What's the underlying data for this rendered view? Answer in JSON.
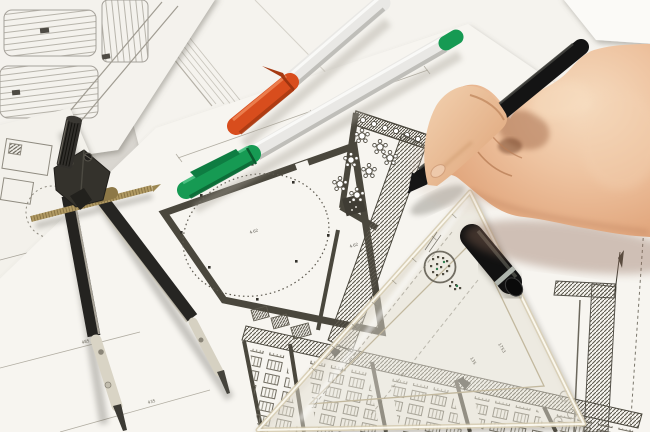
{
  "scene": {
    "description": "Overhead photograph of an architect's desk: a hand holding a black fineliner pen over floor-plan blueprints, a drafting compass with brass adjustment rod, two silver marker pens with orange and green caps, a black pen cap, and a translucent triangle set-square ruler with a round stamp."
  },
  "labels": {
    "level_a": "4.62",
    "level_b": "4.62",
    "dim_a": "485",
    "dim_b": "435",
    "ruler_num_a": "1753",
    "ruler_num_b": "135"
  },
  "colors": {
    "paper_main": "#f7f5f0",
    "paper_mid": "#f5f3ee",
    "paper_park": "#f4f2ed",
    "ink_wall": "#4a473d",
    "line_faint": "#b3afa4",
    "pen_orange": "#d84d1d",
    "pen_orange_dark": "#a53911",
    "pen_green": "#169a53",
    "pen_green_dark": "#0b6a36",
    "pen_silver": "#e9e8e5",
    "brass": "#b19a63",
    "compass_dark": "#2a2926",
    "metal_light": "#d9d4c5",
    "skin": "#eec3a0",
    "skin_shadow": "#c08a63",
    "black_pen": "#141414",
    "ruler_fill": "rgba(247,242,229,0.42)",
    "stamp": "#716d62"
  }
}
